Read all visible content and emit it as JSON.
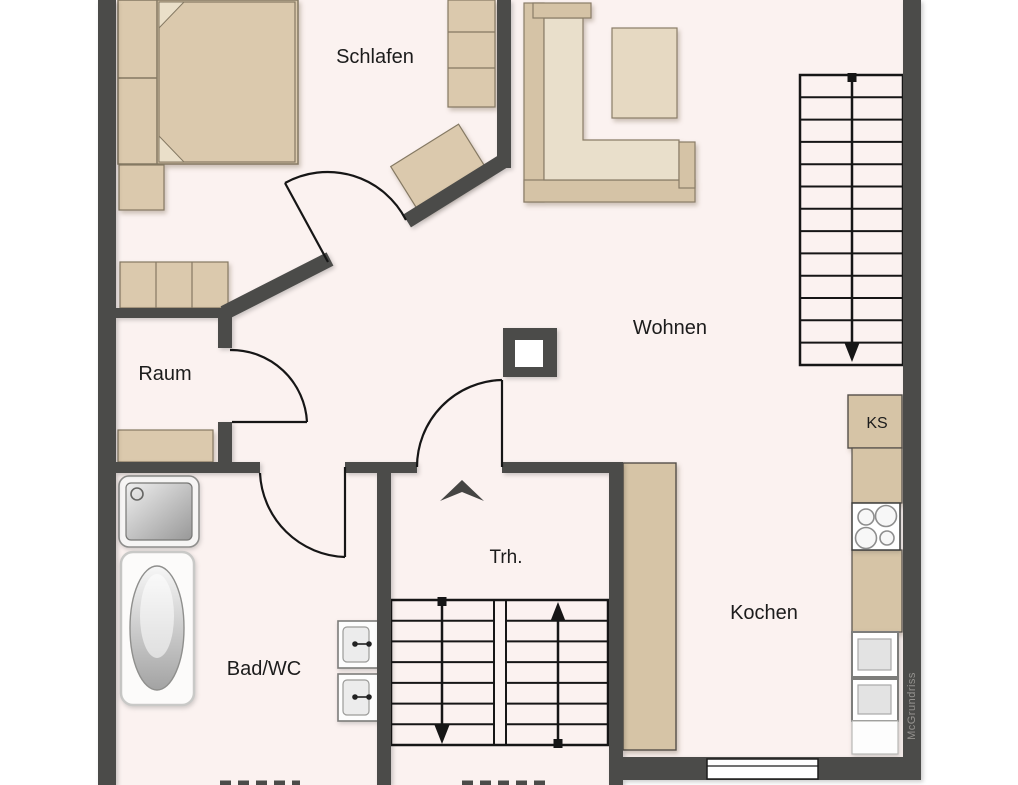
{
  "floorplan": {
    "rooms": [
      {
        "name": "schlafen",
        "label": "Schlafen"
      },
      {
        "name": "wohnen",
        "label": "Wohnen"
      },
      {
        "name": "raum",
        "label": "Raum"
      },
      {
        "name": "bad-wc",
        "label": "Bad/WC"
      },
      {
        "name": "treppenhaus",
        "label": "Trh."
      },
      {
        "name": "kochen",
        "label": "Kochen"
      }
    ],
    "labels": {
      "fridge": "KS",
      "watermark": "McGrundriss"
    },
    "stairs": {
      "wohnen_staircase": {
        "steps": 13,
        "direction": "down"
      },
      "trh_left_flight": {
        "steps": 7,
        "direction": "down"
      },
      "trh_right_flight": {
        "steps": 7,
        "direction": "up"
      }
    },
    "colors": {
      "wall": "#4b4b49",
      "floor": "#fbf2f0",
      "furniture": "#dbc9ad",
      "furniture_light": "#e9dfcb",
      "kitchen_counter": "#d6c4a6",
      "line": "#161616",
      "watermark_text": "#94928f"
    }
  }
}
